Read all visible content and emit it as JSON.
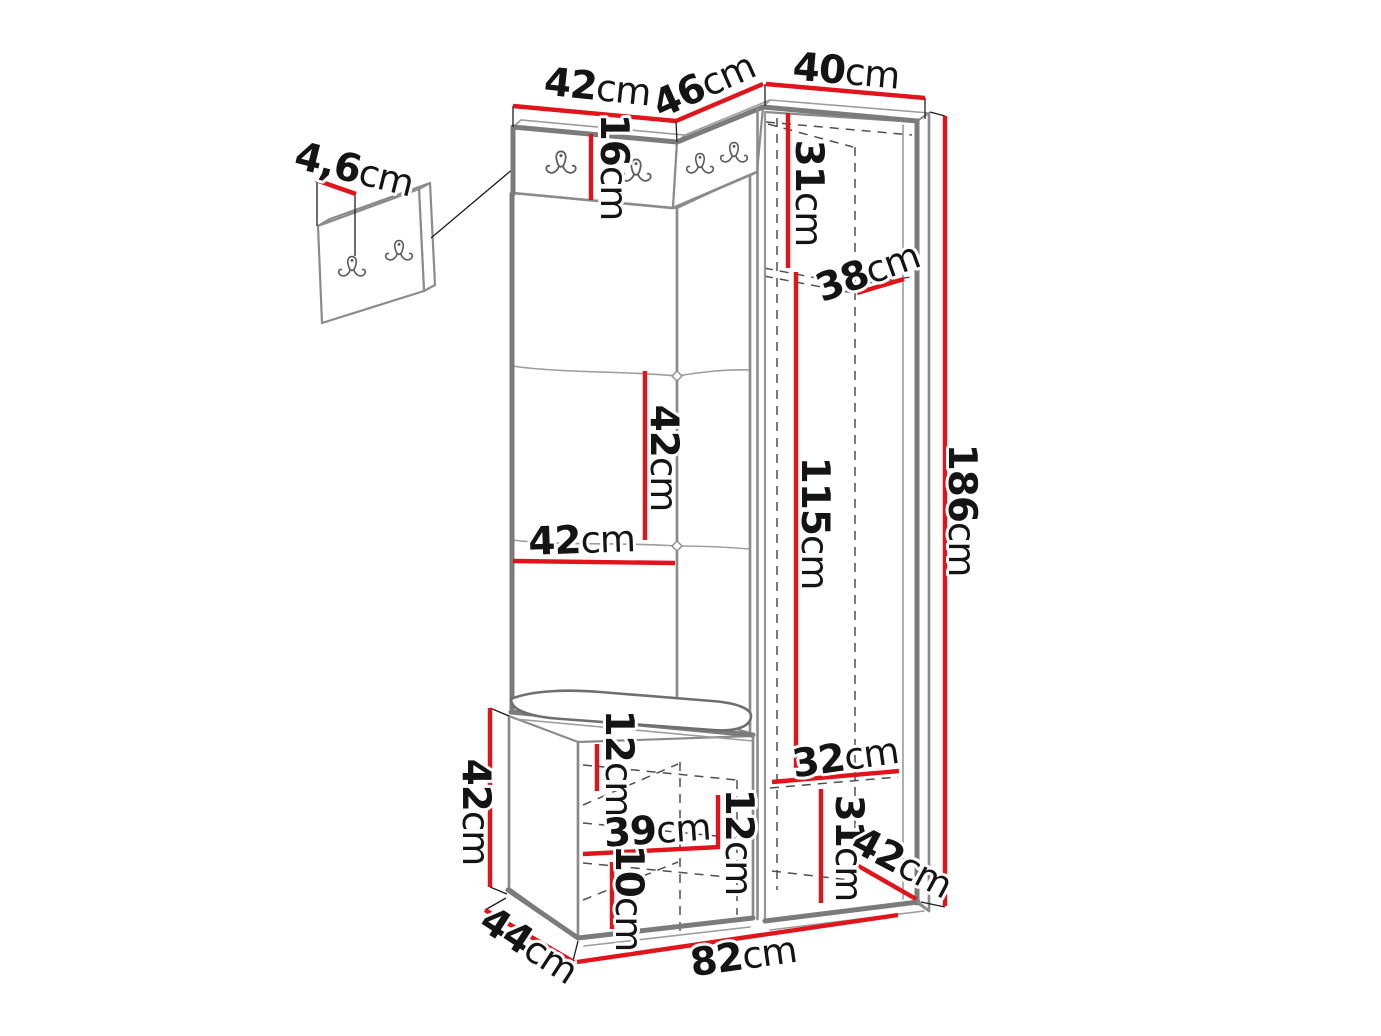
{
  "diagram": {
    "type": "furniture dimension drawing",
    "subject": "hallway set: coat-hook strip with upholstered panels, corner shoe bench and tall wardrobe cabinet",
    "unit": "cm",
    "colors": {
      "background": "#ffffff",
      "dimension_line_red": "#e0141a",
      "outline_gray": "#7b7b7b",
      "hidden_line_gray": "#4f4f4f",
      "label_black": "#141414"
    },
    "icons": {
      "coat_hook": "double coat hook",
      "main_strip_hook_count": 4,
      "detail_panel_hook_count": 2
    }
  },
  "dims": {
    "detail_panel_thickness": {
      "num": "4,6",
      "unit": "cm"
    },
    "top_left_width": {
      "num": "42",
      "unit": "cm"
    },
    "top_corner_width": {
      "num": "46",
      "unit": "cm"
    },
    "top_right_width": {
      "num": "40",
      "unit": "cm"
    },
    "hook_strip_height": {
      "num": "16",
      "unit": "cm"
    },
    "cab_upper_height": {
      "num": "31",
      "unit": "cm"
    },
    "cab_shelf_depth": {
      "num": "38",
      "unit": "cm"
    },
    "cab_hanging_height": {
      "num": "115",
      "unit": "cm"
    },
    "total_height": {
      "num": "186",
      "unit": "cm"
    },
    "panel_tile_height": {
      "num": "42",
      "unit": "cm"
    },
    "panel_tile_width": {
      "num": "42",
      "unit": "cm"
    },
    "bench_height": {
      "num": "42",
      "unit": "cm"
    },
    "bench_depth": {
      "num": "44",
      "unit": "cm"
    },
    "bottom_width": {
      "num": "82",
      "unit": "cm"
    },
    "seat_clearance": {
      "num": "12",
      "unit": "cm"
    },
    "bench_shelf_width": {
      "num": "39",
      "unit": "cm"
    },
    "bench_shelf_height": {
      "num": "12",
      "unit": "cm"
    },
    "bench_plinth_height": {
      "num": "10",
      "unit": "cm"
    },
    "cab_lower_shelf_width": {
      "num": "32",
      "unit": "cm"
    },
    "cab_lower_height": {
      "num": "31",
      "unit": "cm"
    },
    "cab_depth": {
      "num": "42",
      "unit": "cm"
    }
  }
}
